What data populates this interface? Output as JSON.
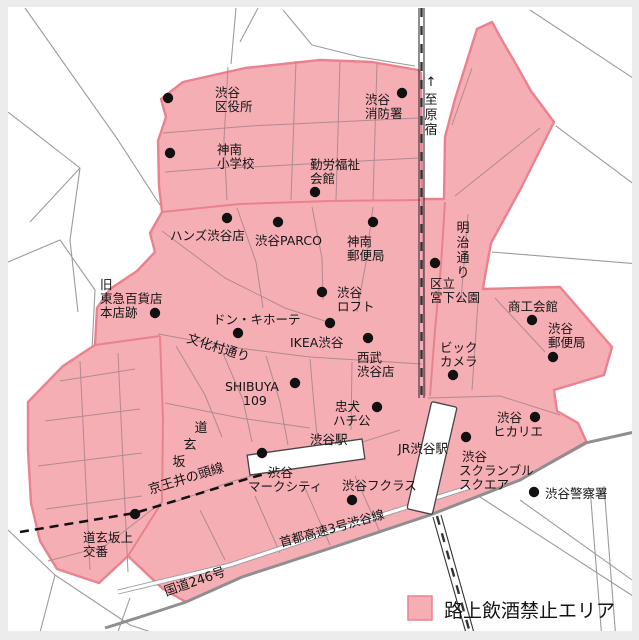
{
  "legend": {
    "label": "路上飲酒禁止エリア",
    "swatch_color": "#F5AEB4"
  },
  "colors": {
    "zone_fill": "#F5AEB4",
    "zone_border": "#E9828E"
  },
  "labels": {
    "ward_office": [
      "渋谷",
      "区役所"
    ],
    "jinnan_school": [
      "神南",
      "小学校"
    ],
    "labor_hall": [
      "勤労福祉",
      "会館"
    ],
    "fire_station": [
      "渋谷",
      "消防署"
    ],
    "hands": "ハンズ渋谷店",
    "parco": "渋谷PARCO",
    "jinnan_post": [
      "神南",
      "郵便局"
    ],
    "miyashita_park": [
      "区立",
      "宮下公園"
    ],
    "loft": [
      "渋谷",
      "ロフト"
    ],
    "old_tokyu": [
      "旧",
      "東急百貨店",
      "本店跡"
    ],
    "donki": "ドン・キホーテ",
    "ikea": "IKEA渋谷",
    "seibu": [
      "西武",
      "渋谷店"
    ],
    "shoko_kaikan": "商工会館",
    "shibuya_post": [
      "渋谷",
      "郵便局"
    ],
    "bic_camera": [
      "ビック",
      "カメラ"
    ],
    "shibuya109": [
      "SHIBUYA",
      "109"
    ],
    "hachiko": [
      "忠犬",
      "ハチ公"
    ],
    "shibuya_station": "渋谷駅",
    "mark_city": [
      "渋谷",
      "マークシティ"
    ],
    "fukuras": "渋谷フクラス",
    "jr_station": "JR渋谷駅",
    "scramble_square": [
      "渋谷",
      "スクランブル",
      "スクエア"
    ],
    "hikarie": [
      "渋谷",
      "ヒカリエ"
    ],
    "police": "渋谷警察署",
    "koban": [
      "道玄坂上",
      "交番"
    ],
    "bunkamura_dori": "文化村通り",
    "dogenzaka": [
      "道",
      "玄",
      "坂"
    ],
    "keio_line": "京王井の頭線",
    "route246": "国道246号",
    "shuto_expwy": "首都高速3号渋谷線",
    "meiji_dori": [
      "明",
      "治",
      "通",
      "り"
    ],
    "to_harajuku": [
      "↑",
      "至",
      "原",
      "宿"
    ]
  }
}
